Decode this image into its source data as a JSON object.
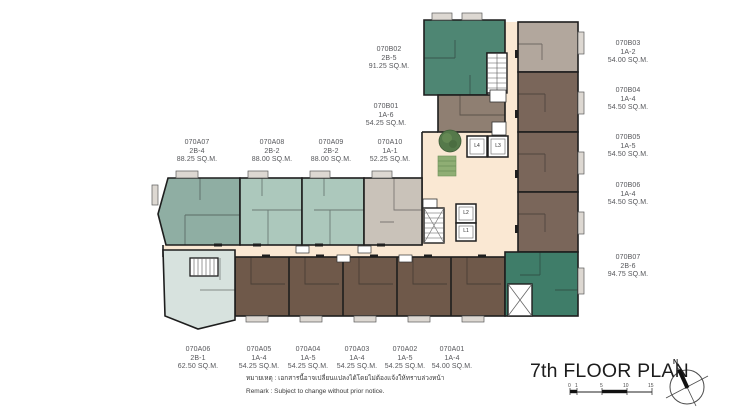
{
  "page": {
    "title": "7th FLOOR PLAN"
  },
  "remark": {
    "thai": "หมายเหตุ : เอกสารนี้อาจเปลี่ยนแปลงได้โดยไม่ต้องแจ้งให้ทราบล่วงหน้า",
    "english": "Remark   : Subject to change without prior notice."
  },
  "compass": {
    "north_label": "N"
  },
  "scale_bar": {
    "ticks": [
      "0",
      "1",
      "5",
      "10",
      "15"
    ]
  },
  "elevators": [
    {
      "label": "L4"
    },
    {
      "label": "L3"
    },
    {
      "label": "L2"
    },
    {
      "label": "L1"
    }
  ],
  "units": [
    {
      "id": "070A07",
      "type": "2B-4",
      "area": "88.25 SQ.M."
    },
    {
      "id": "070A08",
      "type": "2B-2",
      "area": "88.00 SQ.M."
    },
    {
      "id": "070A09",
      "type": "2B-2",
      "area": "88.00 SQ.M."
    },
    {
      "id": "070A10",
      "type": "1A-1",
      "area": "52.25 SQ.M."
    },
    {
      "id": "070B02",
      "type": "2B-5",
      "area": "91.25 SQ.M."
    },
    {
      "id": "070B01",
      "type": "1A-6",
      "area": "54.25 SQ.M."
    },
    {
      "id": "070B03",
      "type": "1A-2",
      "area": "54.00 SQ.M."
    },
    {
      "id": "070B04",
      "type": "1A-4",
      "area": "54.50 SQ.M."
    },
    {
      "id": "070B05",
      "type": "1A-5",
      "area": "54.50 SQ.M."
    },
    {
      "id": "070B06",
      "type": "1A-4",
      "area": "54.50 SQ.M."
    },
    {
      "id": "070B07",
      "type": "2B-6",
      "area": "94.75 SQ.M."
    },
    {
      "id": "070A06",
      "type": "2B-1",
      "area": "62.50 SQ.M."
    },
    {
      "id": "070A05",
      "type": "1A-4",
      "area": "54.25 SQ.M."
    },
    {
      "id": "070A04",
      "type": "1A-5",
      "area": "54.25 SQ.M."
    },
    {
      "id": "070A03",
      "type": "1A-4",
      "area": "54.25 SQ.M."
    },
    {
      "id": "070A02",
      "type": "1A-5",
      "area": "54.25 SQ.M."
    },
    {
      "id": "070A01",
      "type": "1A-4",
      "area": "54.00 SQ.M."
    }
  ],
  "colors": {
    "unit_teal_dark": "#4E8673",
    "unit_teal_deep": "#3F7D69",
    "unit_sage": "#8FAEA3",
    "unit_seafoam": "#ACC8BC",
    "unit_brown": "#6F594A",
    "unit_brown_light": "#7A665A",
    "unit_taupe": "#8F7F72",
    "unit_gray": "#B2A79D",
    "unit_gray_light": "#C9C2B9",
    "unit_pale_blue": "#D7E2DE",
    "corridor_cream": "#FAE8D3",
    "wall": "#1E1E1E",
    "landscape_green": "#55794A"
  }
}
